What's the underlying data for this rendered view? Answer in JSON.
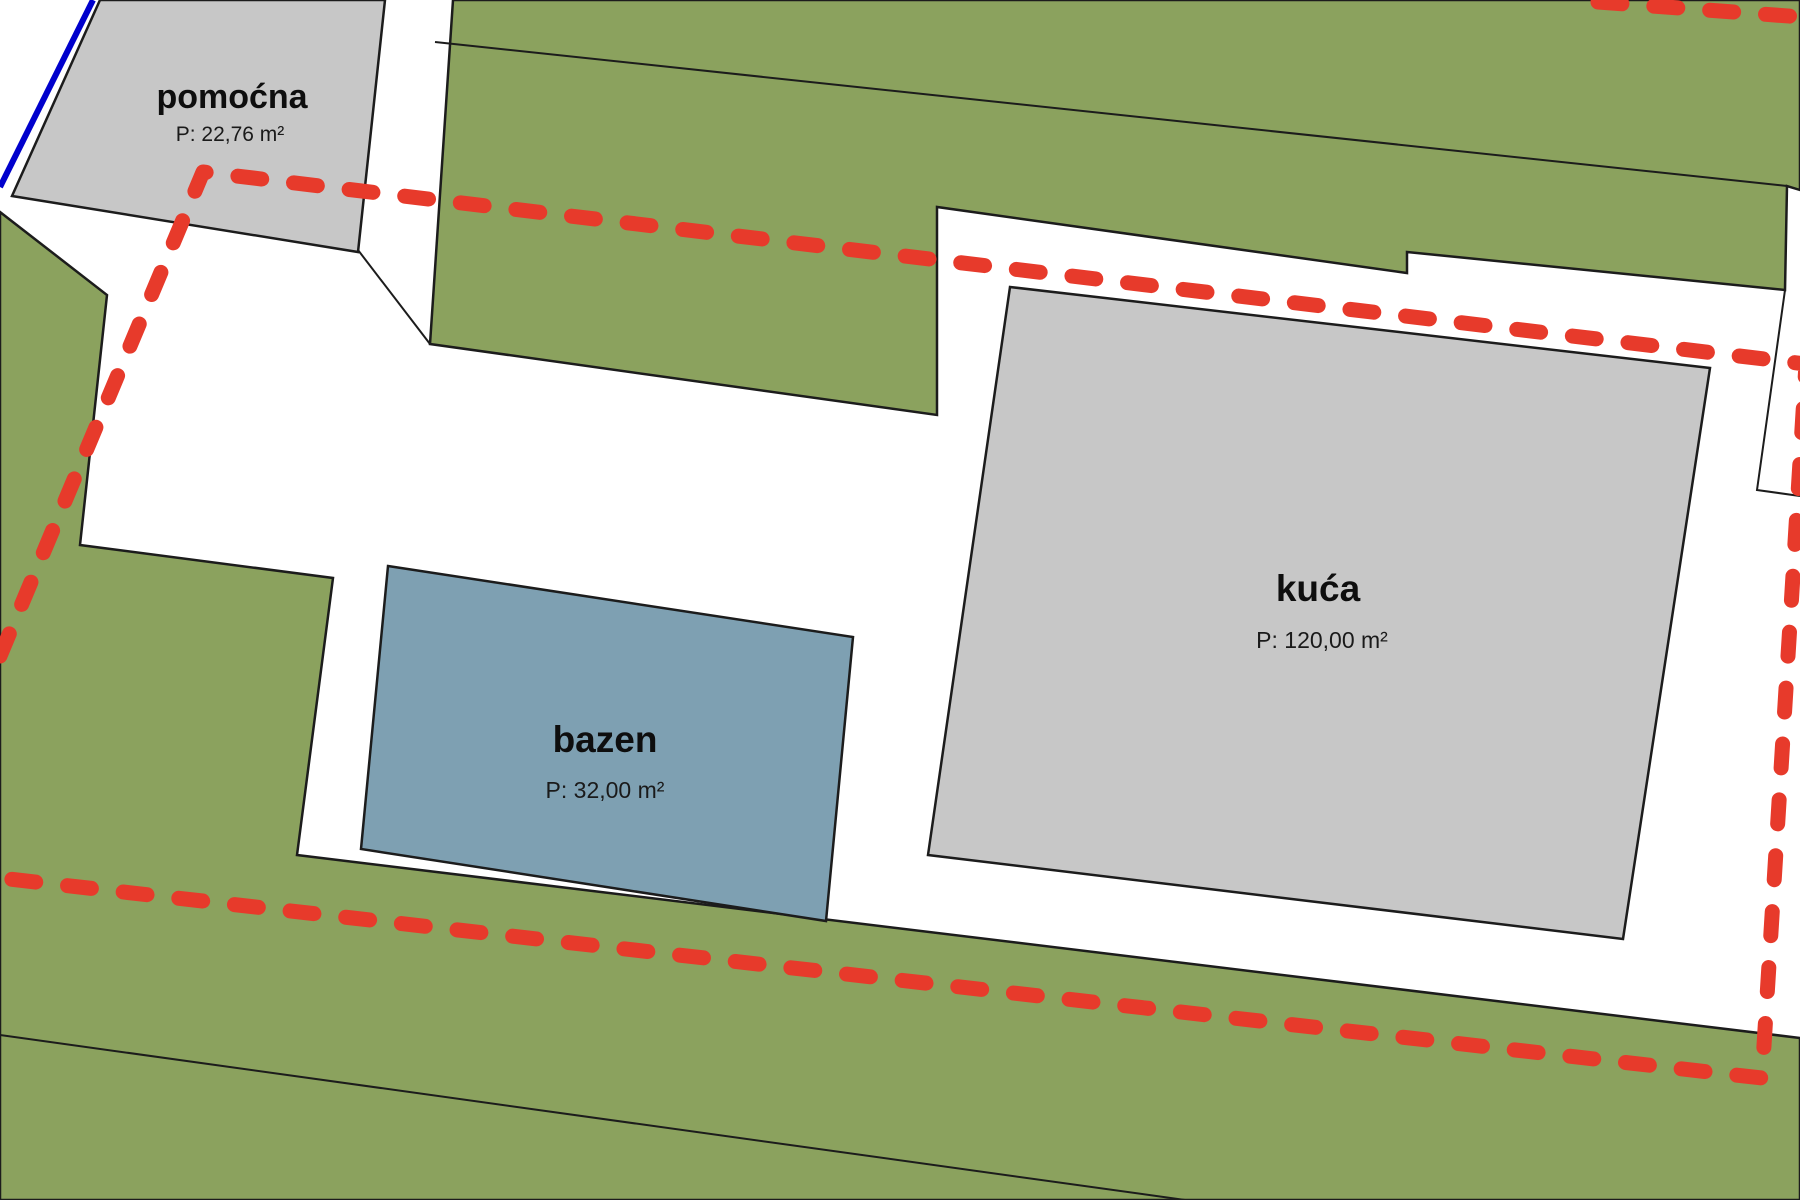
{
  "map": {
    "type": "cadastral-site-plan",
    "colors": {
      "parcel_green": "#8BA25E",
      "building_gray": "#C7C7C7",
      "pool_blue": "#7EA0B2",
      "boundary_red": "#E73A2B",
      "cadastre_blue": "#0000CD",
      "line_black": "#1c1c1c",
      "background_white": "#ffffff"
    },
    "features": {
      "auxiliary_building": {
        "label": "pomoćna",
        "area_label": "P: 22,76 m²"
      },
      "house": {
        "label": "kuća",
        "area_label": "P: 120,00 m²"
      },
      "pool": {
        "label": "bazen",
        "area_label": "P: 32,00 m²"
      }
    },
    "boundary": {
      "style": "red-dashed",
      "meaning": "highlighted-parcel-boundary"
    }
  }
}
